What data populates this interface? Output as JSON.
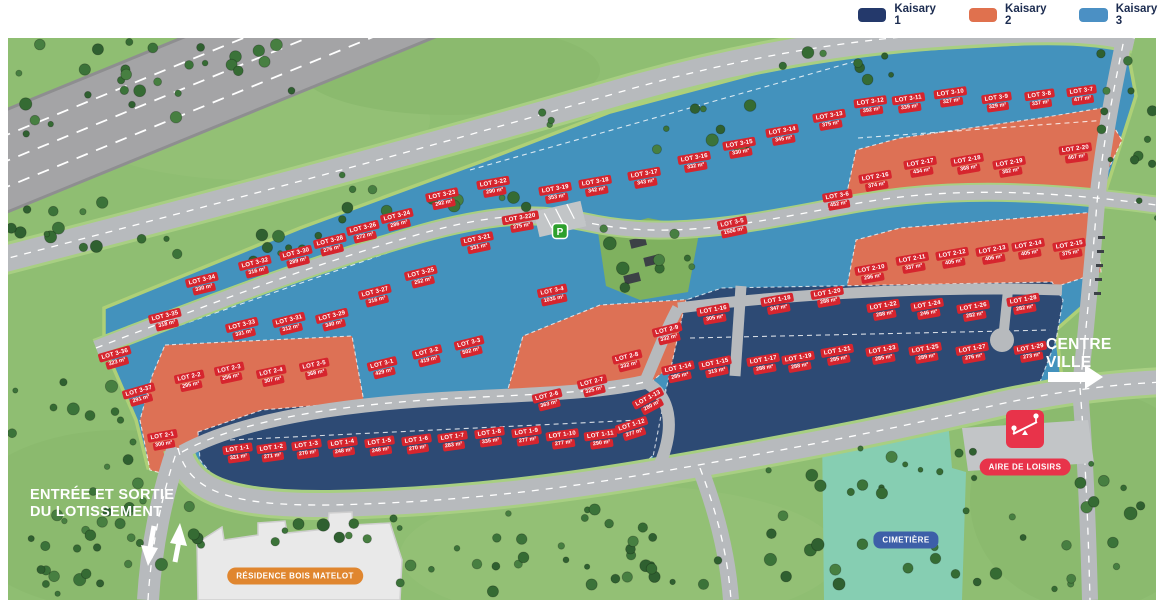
{
  "legend": {
    "items": [
      {
        "label": "Kaisary 1",
        "color": "#24396b"
      },
      {
        "label": "Kaisary 2",
        "color": "#e0714e"
      },
      {
        "label": "Kaisary 3",
        "color": "#4b90c4"
      }
    ]
  },
  "map": {
    "labels": {
      "entrance_line1": "ENTRÉE ET SORTIE",
      "entrance_line2": "DU LOTISSEMENT",
      "centre_line1": "CENTRE",
      "centre_line2": "VILLE",
      "residence": "RÉSIDENCE BOIS MATELOT",
      "aire": "AIRE DE LOISIRS",
      "cimetiere": "CIMETIÈRE",
      "parking": "P"
    },
    "colors": {
      "lot_chip": "#d6252e",
      "kaisary1": "#2d4a74",
      "kaisary2": "#dd7155",
      "kaisary3": "#4392bd",
      "grass": "#8fbe72",
      "road": "#b7babd",
      "railway": "#a4a4a6",
      "cemetery": "#86ceb2",
      "badge_residence": "#e0862f",
      "badge_aire": "#e8334a",
      "badge_cimetiere": "#3d5fa8"
    },
    "lots": [
      {
        "name": "LOT 3-1",
        "area": "429 m²",
        "group": 3,
        "x": 383,
        "y": 368,
        "r": -14
      },
      {
        "name": "LOT 3-2",
        "area": "419 m²",
        "group": 3,
        "x": 428,
        "y": 356,
        "r": -14
      },
      {
        "name": "LOT 3-3",
        "area": "502 m²",
        "group": 3,
        "x": 470,
        "y": 347,
        "r": -14
      },
      {
        "name": "LOT 3-4",
        "area": "1035 m²",
        "group": 3,
        "x": 553,
        "y": 295,
        "r": -12
      },
      {
        "name": "LOT 3-5",
        "area": "1506 m²",
        "group": 3,
        "x": 733,
        "y": 227,
        "r": -12
      },
      {
        "name": "LOT 3-6",
        "area": "452 m²",
        "group": 3,
        "x": 838,
        "y": 200,
        "r": -10
      },
      {
        "name": "LOT 3-7",
        "area": "477 m²",
        "group": 3,
        "x": 1082,
        "y": 95,
        "r": -8
      },
      {
        "name": "LOT 3-8",
        "area": "337 m²",
        "group": 3,
        "x": 1040,
        "y": 99,
        "r": -8
      },
      {
        "name": "LOT 3-9",
        "area": "329 m²",
        "group": 3,
        "x": 997,
        "y": 102,
        "r": -8
      },
      {
        "name": "LOT 3-10",
        "area": "327 m²",
        "group": 3,
        "x": 951,
        "y": 97,
        "r": -8
      },
      {
        "name": "LOT 3-11",
        "area": "339 m²",
        "group": 3,
        "x": 909,
        "y": 103,
        "r": -8
      },
      {
        "name": "LOT 3-12",
        "area": "392 m²",
        "group": 3,
        "x": 871,
        "y": 106,
        "r": -8
      },
      {
        "name": "LOT 3-13",
        "area": "375 m²",
        "group": 3,
        "x": 830,
        "y": 120,
        "r": -10
      },
      {
        "name": "LOT 3-14",
        "area": "345 m²",
        "group": 3,
        "x": 783,
        "y": 135,
        "r": -10
      },
      {
        "name": "LOT 3-15",
        "area": "330 m²",
        "group": 3,
        "x": 740,
        "y": 148,
        "r": -10
      },
      {
        "name": "LOT 3-16",
        "area": "332 m²",
        "group": 3,
        "x": 695,
        "y": 162,
        "r": -10
      },
      {
        "name": "LOT 3-17",
        "area": "343 m²",
        "group": 3,
        "x": 645,
        "y": 178,
        "r": -10
      },
      {
        "name": "LOT 3-18",
        "area": "342 m²",
        "group": 3,
        "x": 596,
        "y": 186,
        "r": -10
      },
      {
        "name": "LOT 3-19",
        "area": "353 m²",
        "group": 3,
        "x": 556,
        "y": 193,
        "r": -10
      },
      {
        "name": "LOT 3-220",
        "area": "275 m²",
        "group": 3,
        "x": 521,
        "y": 222,
        "r": -10
      },
      {
        "name": "LOT 3-21",
        "area": "331 m²",
        "group": 3,
        "x": 478,
        "y": 243,
        "r": -12
      },
      {
        "name": "LOT 3-22",
        "area": "290 m²",
        "group": 3,
        "x": 494,
        "y": 187,
        "r": -10
      },
      {
        "name": "LOT 3-23",
        "area": "292 m²",
        "group": 3,
        "x": 443,
        "y": 199,
        "r": -12
      },
      {
        "name": "LOT 3-24",
        "area": "286 m²",
        "group": 3,
        "x": 398,
        "y": 220,
        "r": -14
      },
      {
        "name": "LOT 3-25",
        "area": "252 m²",
        "group": 3,
        "x": 422,
        "y": 277,
        "r": -14
      },
      {
        "name": "LOT 3-26",
        "area": "272 m²",
        "group": 3,
        "x": 364,
        "y": 232,
        "r": -14
      },
      {
        "name": "LOT 3-27",
        "area": "316 m²",
        "group": 3,
        "x": 376,
        "y": 296,
        "r": -14
      },
      {
        "name": "LOT 3-28",
        "area": "276 m²",
        "group": 3,
        "x": 331,
        "y": 245,
        "r": -14
      },
      {
        "name": "LOT 3-29",
        "area": "340 m²",
        "group": 3,
        "x": 333,
        "y": 320,
        "r": -14
      },
      {
        "name": "LOT 3-30",
        "area": "289 m²",
        "group": 3,
        "x": 297,
        "y": 257,
        "r": -14
      },
      {
        "name": "LOT 3-31",
        "area": "312 m²",
        "group": 3,
        "x": 290,
        "y": 324,
        "r": -14
      },
      {
        "name": "LOT 3-32",
        "area": "316 m²",
        "group": 3,
        "x": 256,
        "y": 267,
        "r": -14
      },
      {
        "name": "LOT 3-33",
        "area": "331 m²",
        "group": 3,
        "x": 243,
        "y": 329,
        "r": -14
      },
      {
        "name": "LOT 3-34",
        "area": "330 m²",
        "group": 3,
        "x": 203,
        "y": 284,
        "r": -14
      },
      {
        "name": "LOT 3-35",
        "area": "318 m²",
        "group": 3,
        "x": 166,
        "y": 320,
        "r": -14
      },
      {
        "name": "LOT 3-36",
        "area": "323 m²",
        "group": 3,
        "x": 116,
        "y": 358,
        "r": -16
      },
      {
        "name": "LOT 3-37",
        "area": "291 m²",
        "group": 3,
        "x": 140,
        "y": 395,
        "r": -16
      },
      {
        "name": "LOT 2-1",
        "area": "300 m²",
        "group": 2,
        "x": 163,
        "y": 440,
        "r": -10
      },
      {
        "name": "LOT 2-2",
        "area": "295 m²",
        "group": 2,
        "x": 190,
        "y": 381,
        "r": -12
      },
      {
        "name": "LOT 2-3",
        "area": "256 m²",
        "group": 2,
        "x": 230,
        "y": 373,
        "r": -12
      },
      {
        "name": "LOT 2-4",
        "area": "307 m²",
        "group": 2,
        "x": 272,
        "y": 376,
        "r": -12
      },
      {
        "name": "LOT 2-5",
        "area": "368 m²",
        "group": 2,
        "x": 315,
        "y": 369,
        "r": -12
      },
      {
        "name": "LOT 2-6",
        "area": "363 m²",
        "group": 2,
        "x": 548,
        "y": 400,
        "r": -14
      },
      {
        "name": "LOT 2-7",
        "area": "325 m²",
        "group": 2,
        "x": 593,
        "y": 386,
        "r": -14
      },
      {
        "name": "LOT 2-8",
        "area": "332 m²",
        "group": 2,
        "x": 628,
        "y": 361,
        "r": -14
      },
      {
        "name": "LOT 2-9",
        "area": "332 m²",
        "group": 2,
        "x": 668,
        "y": 334,
        "r": -14
      },
      {
        "name": "LOT 2-10",
        "area": "296 m²",
        "group": 2,
        "x": 872,
        "y": 273,
        "r": -10
      },
      {
        "name": "LOT 2-11",
        "area": "337 m²",
        "group": 2,
        "x": 913,
        "y": 263,
        "r": -10
      },
      {
        "name": "LOT 2-12",
        "area": "405 m²",
        "group": 2,
        "x": 953,
        "y": 258,
        "r": -10
      },
      {
        "name": "LOT 2-13",
        "area": "406 m²",
        "group": 2,
        "x": 993,
        "y": 254,
        "r": -10
      },
      {
        "name": "LOT 2-14",
        "area": "405 m²",
        "group": 2,
        "x": 1029,
        "y": 249,
        "r": -10
      },
      {
        "name": "LOT 2-15",
        "area": "375 m²",
        "group": 2,
        "x": 1070,
        "y": 249,
        "r": -10
      },
      {
        "name": "LOT 2-16",
        "area": "374 m²",
        "group": 2,
        "x": 876,
        "y": 181,
        "r": -10
      },
      {
        "name": "LOT 2-17",
        "area": "434 m²",
        "group": 2,
        "x": 921,
        "y": 167,
        "r": -10
      },
      {
        "name": "LOT 2-18",
        "area": "368 m²",
        "group": 2,
        "x": 968,
        "y": 164,
        "r": -10
      },
      {
        "name": "LOT 2-19",
        "area": "382 m²",
        "group": 2,
        "x": 1010,
        "y": 167,
        "r": -10
      },
      {
        "name": "LOT 2-20",
        "area": "467 m²",
        "group": 2,
        "x": 1076,
        "y": 153,
        "r": -8
      },
      {
        "name": "LOT 1-1",
        "area": "321 m²",
        "group": 1,
        "x": 238,
        "y": 453,
        "r": -8
      },
      {
        "name": "LOT 1-2",
        "area": "271 m²",
        "group": 1,
        "x": 272,
        "y": 452,
        "r": -8
      },
      {
        "name": "LOT 1-3",
        "area": "270 m²",
        "group": 1,
        "x": 307,
        "y": 449,
        "r": -8
      },
      {
        "name": "LOT 1-4",
        "area": "248 m²",
        "group": 1,
        "x": 343,
        "y": 447,
        "r": -8
      },
      {
        "name": "LOT 1-5",
        "area": "248 m²",
        "group": 1,
        "x": 380,
        "y": 446,
        "r": -8
      },
      {
        "name": "LOT 1-6",
        "area": "270 m²",
        "group": 1,
        "x": 417,
        "y": 444,
        "r": -8
      },
      {
        "name": "LOT 1-7",
        "area": "283 m²",
        "group": 1,
        "x": 453,
        "y": 441,
        "r": -8
      },
      {
        "name": "LOT 1-8",
        "area": "335 m²",
        "group": 1,
        "x": 490,
        "y": 437,
        "r": -8
      },
      {
        "name": "LOT 1-9",
        "area": "277 m²",
        "group": 1,
        "x": 527,
        "y": 436,
        "r": -8
      },
      {
        "name": "LOT 1-10",
        "area": "277 m²",
        "group": 1,
        "x": 563,
        "y": 439,
        "r": -8
      },
      {
        "name": "LOT 1-11",
        "area": "290 m²",
        "group": 1,
        "x": 601,
        "y": 439,
        "r": -8
      },
      {
        "name": "LOT 1-12",
        "area": "277 m²",
        "group": 1,
        "x": 633,
        "y": 429,
        "r": -18
      },
      {
        "name": "LOT 1-13",
        "area": "280 m²",
        "group": 1,
        "x": 650,
        "y": 402,
        "r": -28
      },
      {
        "name": "LOT 1-14",
        "area": "285 m²",
        "group": 1,
        "x": 679,
        "y": 372,
        "r": -12
      },
      {
        "name": "LOT 1-15",
        "area": "313 m²",
        "group": 1,
        "x": 716,
        "y": 367,
        "r": -12
      },
      {
        "name": "LOT 1-16",
        "area": "305 m²",
        "group": 1,
        "x": 714,
        "y": 314,
        "r": -10
      },
      {
        "name": "LOT 1-17",
        "area": "288 m²",
        "group": 1,
        "x": 764,
        "y": 364,
        "r": -10
      },
      {
        "name": "LOT 1-18",
        "area": "347 m²",
        "group": 1,
        "x": 778,
        "y": 304,
        "r": -10
      },
      {
        "name": "LOT 1-19",
        "area": "288 m²",
        "group": 1,
        "x": 799,
        "y": 362,
        "r": -10
      },
      {
        "name": "LOT 1-20",
        "area": "288 m²",
        "group": 1,
        "x": 828,
        "y": 297,
        "r": -10
      },
      {
        "name": "LOT 1-21",
        "area": "285 m²",
        "group": 1,
        "x": 838,
        "y": 355,
        "r": -10
      },
      {
        "name": "LOT 1-22",
        "area": "288 m²",
        "group": 1,
        "x": 884,
        "y": 310,
        "r": -10
      },
      {
        "name": "LOT 1-23",
        "area": "285 m²",
        "group": 1,
        "x": 883,
        "y": 354,
        "r": -10
      },
      {
        "name": "LOT 1-24",
        "area": "246 m²",
        "group": 1,
        "x": 928,
        "y": 309,
        "r": -10
      },
      {
        "name": "LOT 1-25",
        "area": "289 m²",
        "group": 1,
        "x": 926,
        "y": 353,
        "r": -10
      },
      {
        "name": "LOT 1-26",
        "area": "282 m²",
        "group": 1,
        "x": 974,
        "y": 311,
        "r": -10
      },
      {
        "name": "LOT 1-27",
        "area": "276 m²",
        "group": 1,
        "x": 973,
        "y": 353,
        "r": -10
      },
      {
        "name": "LOT 1-28",
        "area": "282 m²",
        "group": 1,
        "x": 1024,
        "y": 304,
        "r": -10
      },
      {
        "name": "LOT 1-29",
        "area": "273 m²",
        "group": 1,
        "x": 1031,
        "y": 352,
        "r": -10
      }
    ]
  }
}
